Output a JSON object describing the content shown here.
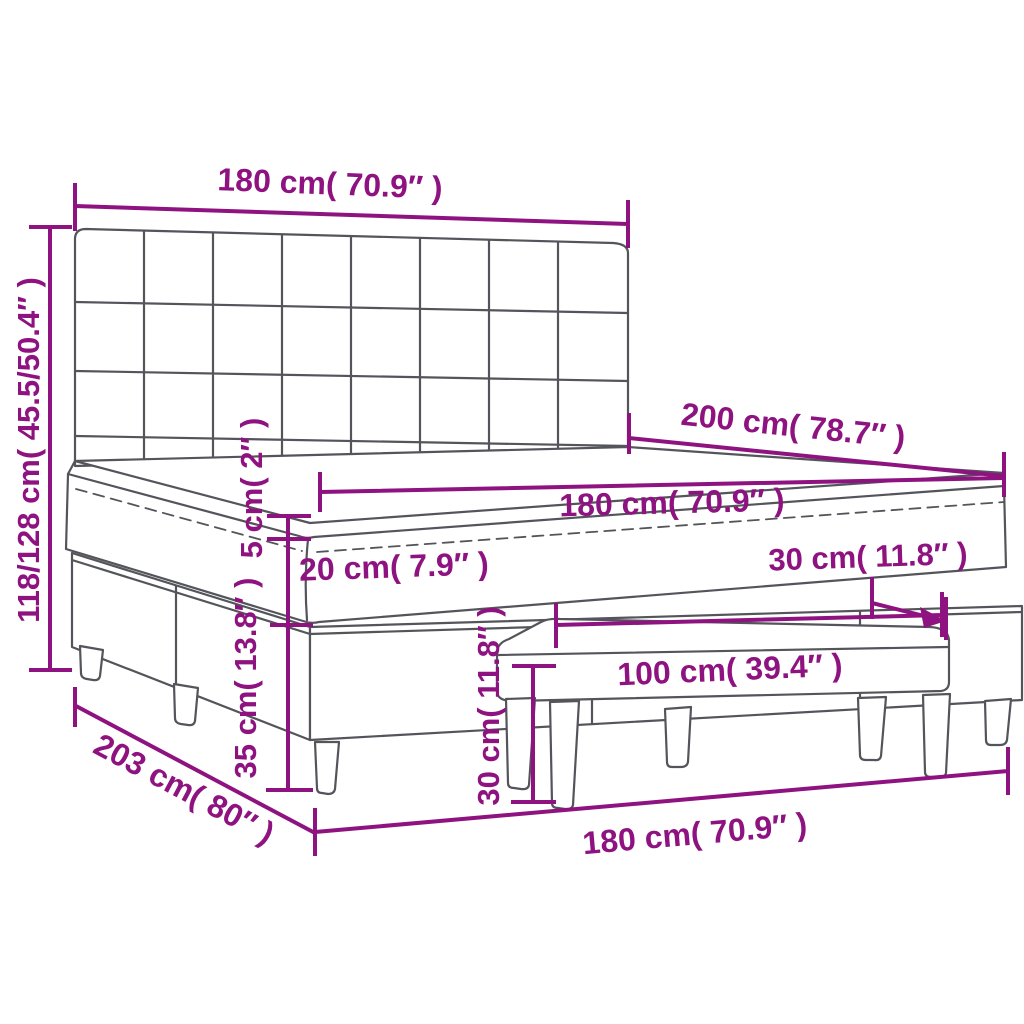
{
  "colors": {
    "dimension_line": "#8e1380",
    "furniture_outline": "#54555b",
    "background": "#ffffff"
  },
  "dims": {
    "headboard_width": "180 cm( 70.9″ )",
    "overall_height": "118/128 cm( 45.5/50.4″ )",
    "bed_length": "200 cm( 78.7″ )",
    "mattress_width": "180 cm( 70.9″ )",
    "topper_thickness": "5 cm( 2″ )",
    "mattress_thickness": "20 cm( 7.9″ )",
    "base_leg_height": "35 cm( 13.8″ )",
    "bench_depth": "30 cm( 11.8″ )",
    "bench_length": "100 cm( 39.4″ )",
    "bench_height": "30 cm( 11.8″ )",
    "overall_length": "203 cm( 80″ )",
    "bed_width_bottom": "180 cm( 70.9″ )"
  }
}
